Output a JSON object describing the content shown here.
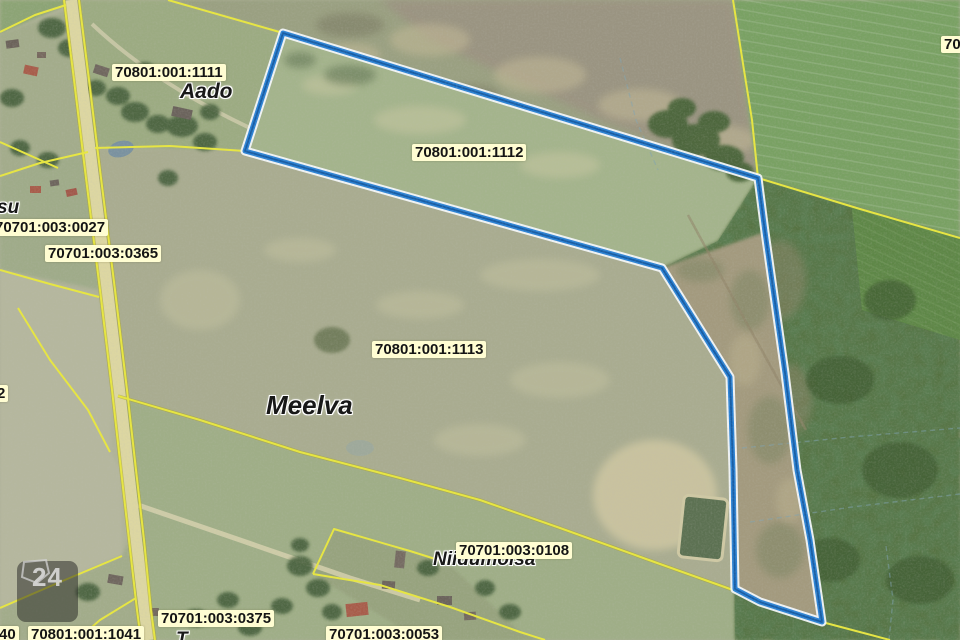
{
  "map": {
    "type": "cadastral-aerial-map",
    "parcel_labels": [
      {
        "text": "70801:001:1111",
        "x": 112,
        "y": 64
      },
      {
        "text": "70801:001:1112",
        "x": 412,
        "y": 144
      },
      {
        "text": "70701:003:0027",
        "x": -8,
        "y": 219
      },
      {
        "text": "70701:003:0365",
        "x": 45,
        "y": 245
      },
      {
        "text": "70801:001:1113",
        "x": 372,
        "y": 341
      },
      {
        "text": "70701:003:0108",
        "x": 456,
        "y": 542
      },
      {
        "text": "70701:003:0375",
        "x": 158,
        "y": 610
      },
      {
        "text": "70801:001:1041",
        "x": 28,
        "y": 626
      },
      {
        "text": "70701:003:0053",
        "x": 326,
        "y": 626
      },
      {
        "text": "40",
        "x": -4,
        "y": 626
      },
      {
        "text": "2",
        "x": -6,
        "y": 385
      },
      {
        "text": "70",
        "x": 941,
        "y": 36
      }
    ],
    "place_labels": [
      {
        "text": "Aado",
        "x": 180,
        "y": 80,
        "size": 21
      },
      {
        "text": "Meelva",
        "x": 266,
        "y": 390,
        "size": 26
      },
      {
        "text": "Niidumõisa",
        "x": 433,
        "y": 549,
        "size": 19
      },
      {
        "text": "su",
        "x": -3,
        "y": 197,
        "size": 19
      },
      {
        "text": "T",
        "x": 176,
        "y": 629,
        "size": 19
      }
    ],
    "selected_parcel": "70801:001:1112",
    "marker": {
      "label": "24"
    },
    "colors": {
      "highlight_outline": "#2b83d6",
      "highlight_core": "#14589f",
      "highlight_casing": "#f4f8fb",
      "cadastral_boundary": "#e8e73f",
      "label_background": "#fffdd2",
      "forest": "#54713f",
      "field": "#aaad93"
    }
  }
}
